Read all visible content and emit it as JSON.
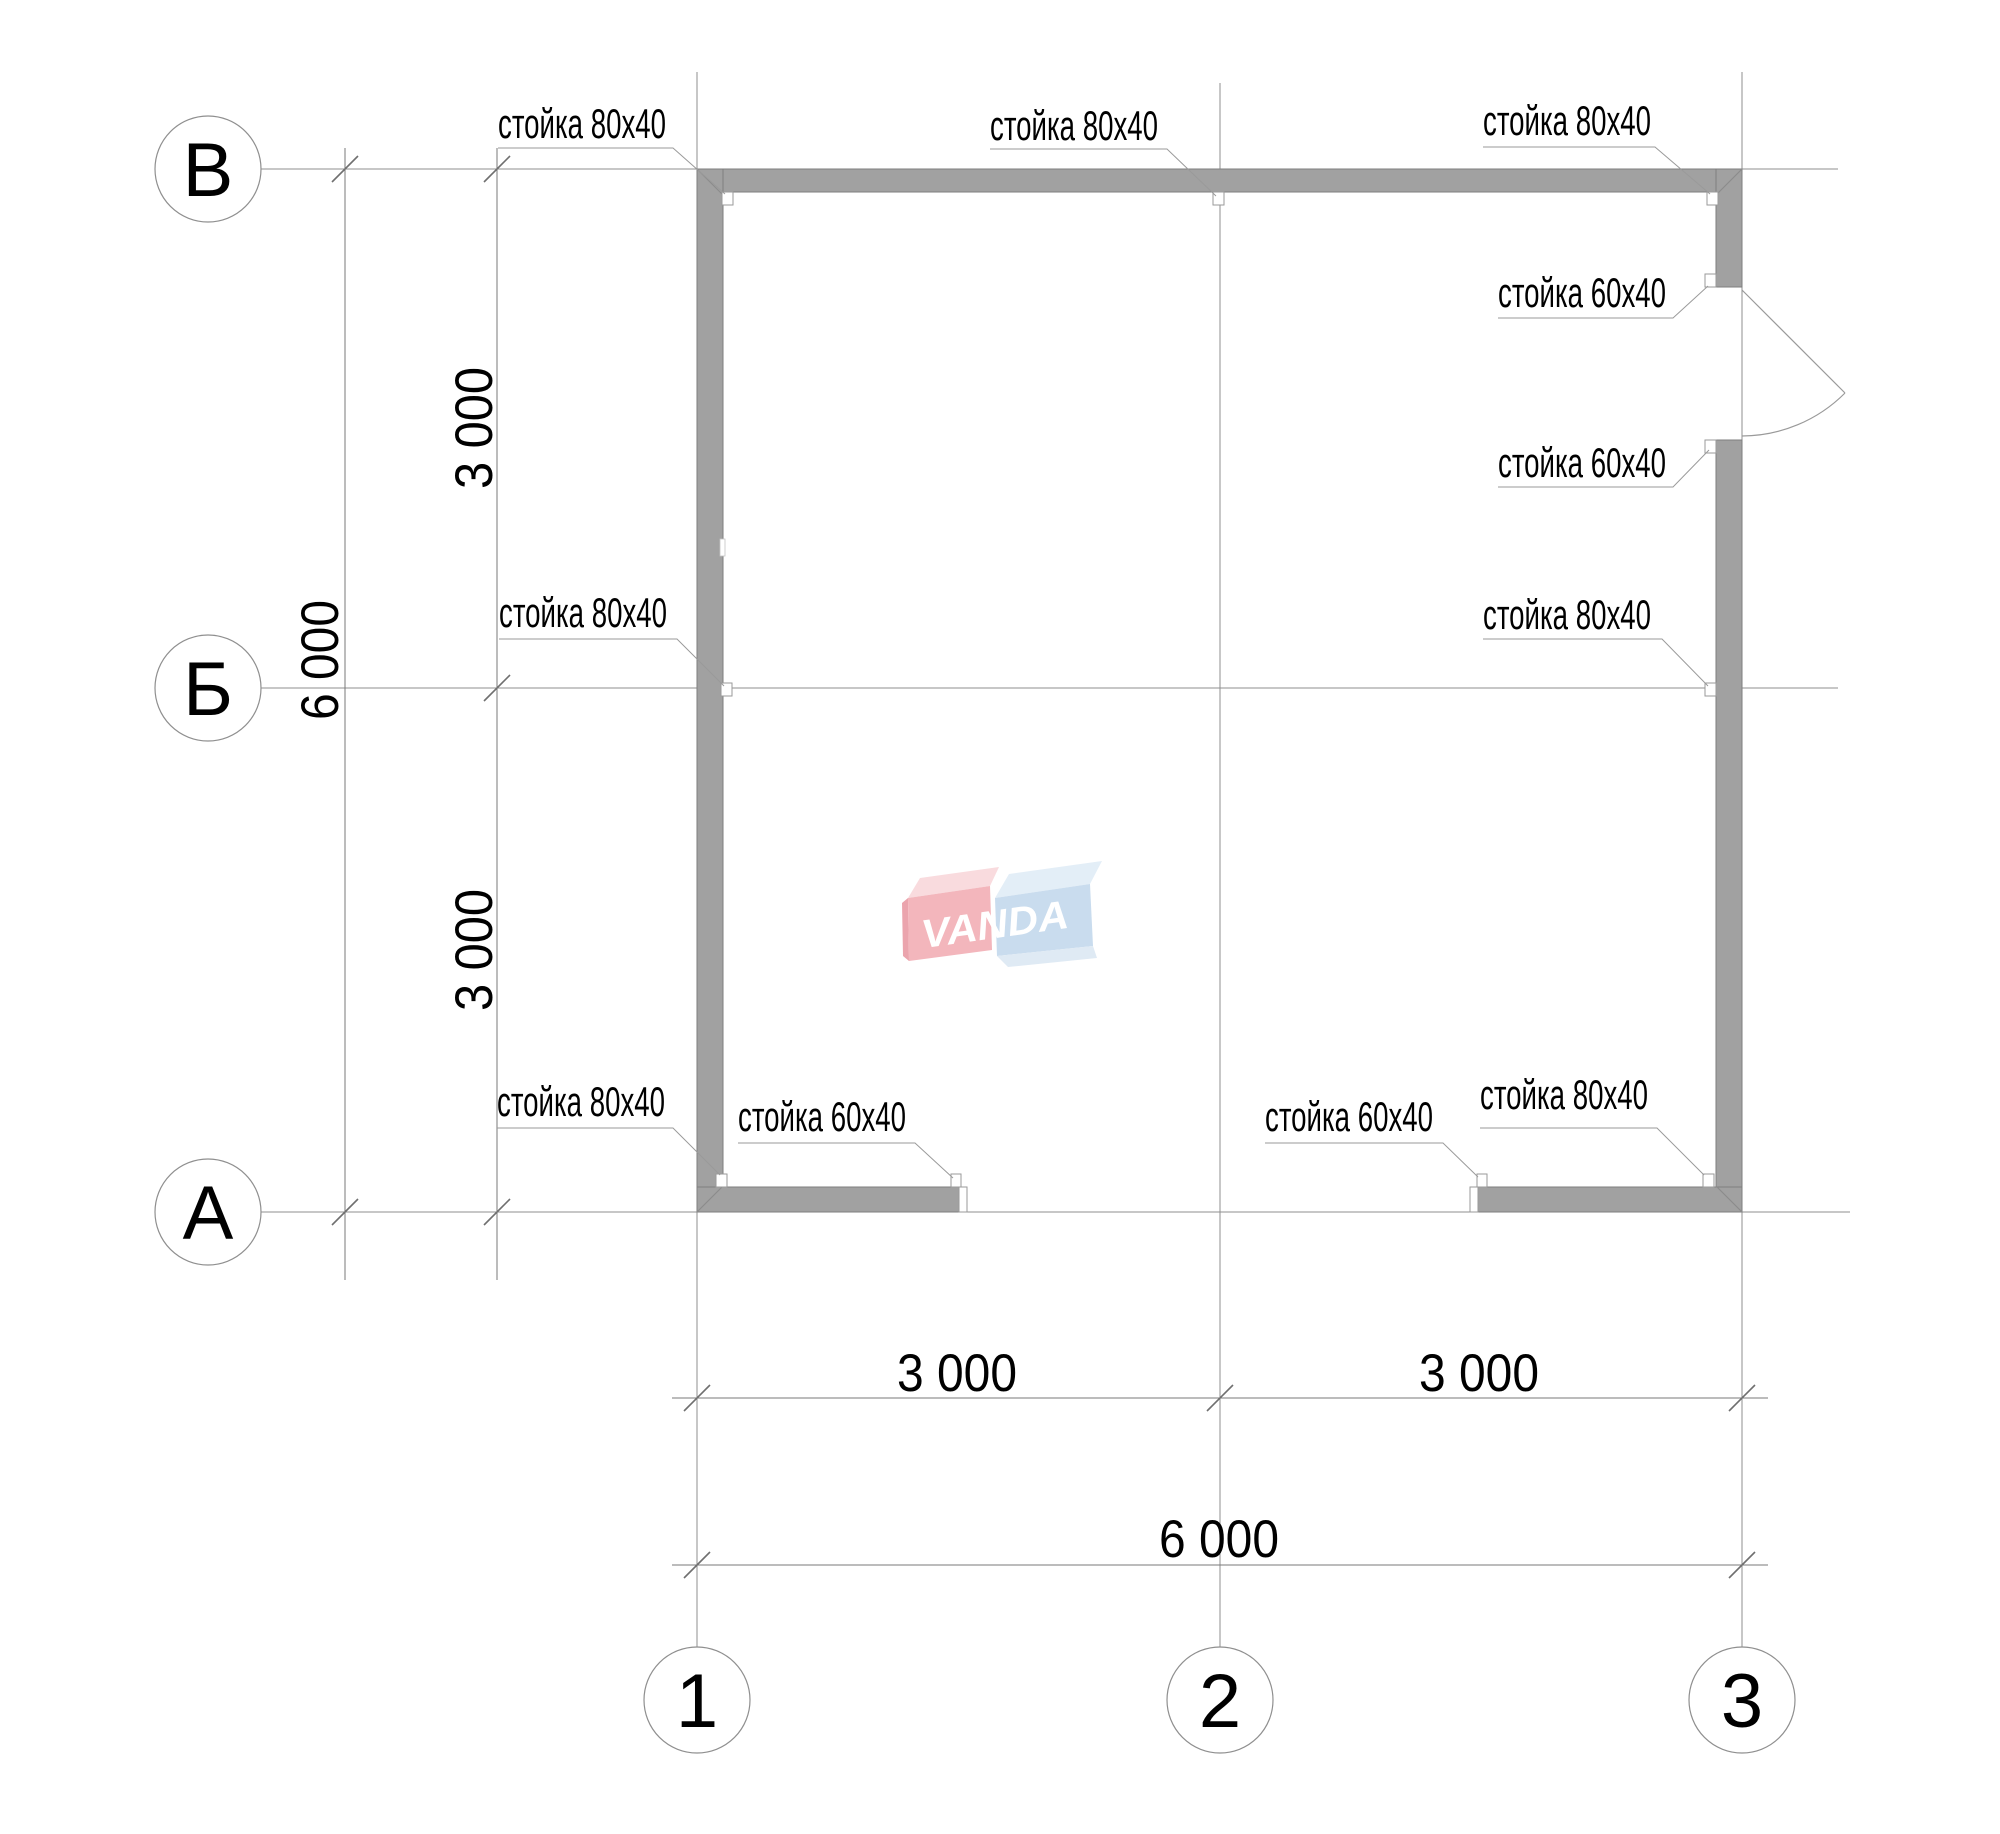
{
  "plan": {
    "axis_row_labels": [
      "В",
      "Б",
      "А"
    ],
    "axis_col_labels": [
      "1",
      "2",
      "3"
    ],
    "dimensions": {
      "left_total": "6 000",
      "left_top_segment": "3 000",
      "left_bottom_segment": "3 000",
      "bottom_left_segment": "3 000",
      "bottom_right_segment": "3 000",
      "bottom_total": "6 000"
    },
    "stud_labels": [
      {
        "text": "стойка 80х40"
      },
      {
        "text": "стойка 80х40"
      },
      {
        "text": "стойка 80х40"
      },
      {
        "text": "стойка 60х40"
      },
      {
        "text": "стойка 60х40"
      },
      {
        "text": "стойка 80х40"
      },
      {
        "text": "стойка 80х40"
      },
      {
        "text": "стойка 80х40"
      },
      {
        "text": "стойка 60х40"
      },
      {
        "text": "стойка 60х40"
      },
      {
        "text": "стойка 80х40"
      }
    ],
    "logo": {
      "text": "VANDA",
      "red_front": "#f3b6bc",
      "red_top": "#f9dbde",
      "red_side": "#eba4ad",
      "blue_front": "#c9dcee",
      "blue_top": "#e3eef7",
      "blue_bottom": "#dfeaf4"
    },
    "colors": {
      "wall_fill": "#a1a1a1"
    }
  }
}
